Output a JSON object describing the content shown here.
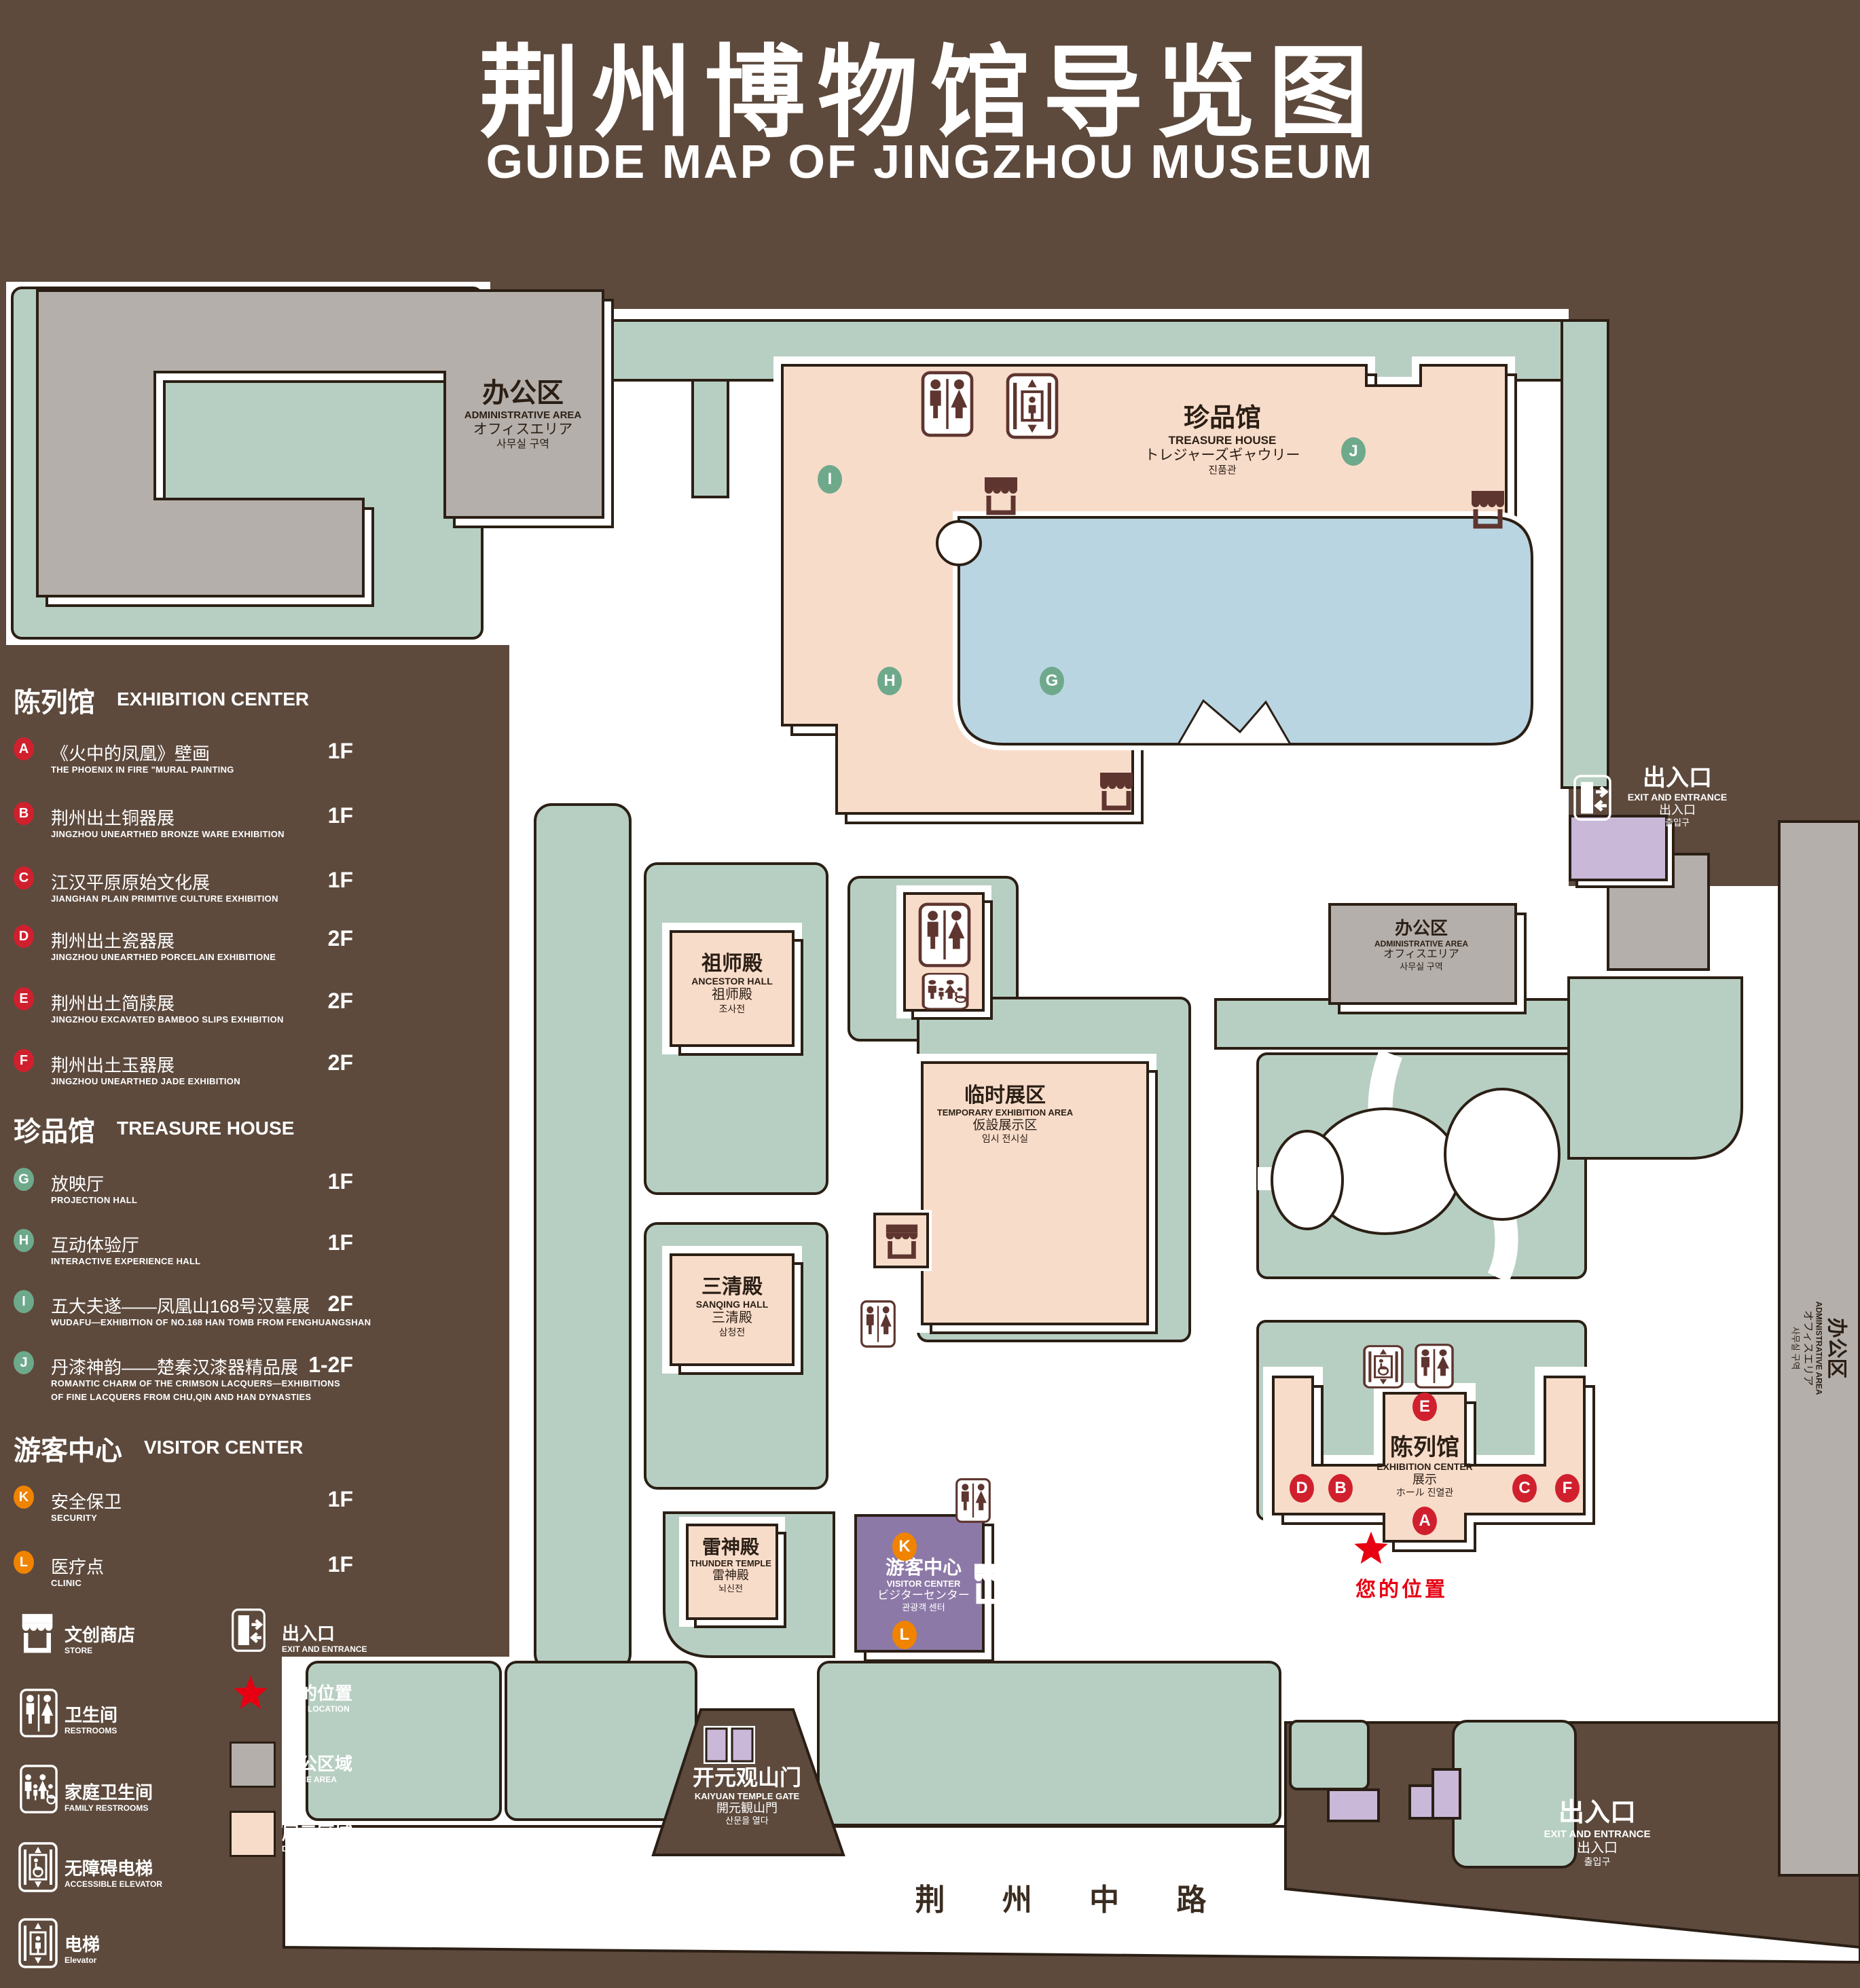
{
  "title": {
    "cn": "荆州博物馆导览图",
    "en": "GUIDE MAP OF JINGZHOU MUSEUM"
  },
  "theme": {
    "background": "#5d4a3d",
    "lawn": "#b7cfc2",
    "display_area": "#f8dcca",
    "office_area": "#b5afab",
    "lake": "#bad5e2",
    "visitor_center": "#8d79a7",
    "lavender": "#c9b8d8",
    "outline": "#2b1f15",
    "marker_red": "#d0202e",
    "marker_green": "#6ea98b",
    "marker_orange": "#f08300",
    "location_red": "#e60012",
    "icon_brown": "#5e352f"
  },
  "legend": {
    "sections": [
      {
        "cn": "陈列馆",
        "en": "EXHIBITION CENTER",
        "items": [
          {
            "letter": "A",
            "cn": "《火中的凤凰》壁画",
            "en": "THE PHOENIX IN FIRE \"MURAL PAINTING",
            "floor": "1F"
          },
          {
            "letter": "B",
            "cn": "荆州出土铜器展",
            "en": "JINGZHOU UNEARTHED BRONZE WARE EXHIBITION",
            "floor": "1F"
          },
          {
            "letter": "C",
            "cn": "江汉平原原始文化展",
            "en": "JIANGHAN PLAIN PRIMITIVE CULTURE EXHIBITION",
            "floor": "1F"
          },
          {
            "letter": "D",
            "cn": "荆州出土瓷器展",
            "en": "JINGZHOU UNEARTHED PORCELAIN EXHIBITIONE",
            "floor": "2F"
          },
          {
            "letter": "E",
            "cn": "荆州出土简牍展",
            "en": "JINGZHOU EXCAVATED BAMBOO SLIPS EXHIBITION",
            "floor": "2F"
          },
          {
            "letter": "F",
            "cn": "荆州出土玉器展",
            "en": "JINGZHOU UNEARTHED JADE EXHIBITION",
            "floor": "2F"
          }
        ]
      },
      {
        "cn": "珍品馆",
        "en": "TREASURE HOUSE",
        "items": [
          {
            "letter": "G",
            "cn": "放映厅",
            "en": "PROJECTION HALL",
            "floor": "1F"
          },
          {
            "letter": "H",
            "cn": "互动体验厅",
            "en": "INTERACTIVE EXPERIENCE HALL",
            "floor": "1F"
          },
          {
            "letter": "I",
            "cn": "五大夫遂——凤凰山168号汉墓展",
            "en": "WUDAFU—EXHIBITION OF NO.168 HAN TOMB FROM FENGHUANGSHAN",
            "floor": "2F"
          },
          {
            "letter": "J",
            "cn": "丹漆神韵——楚秦汉漆器精品展",
            "en": "ROMANTIC CHARM OF THE CRIMSON LACQUERS—EXHIBITIONS",
            "en2": "OF FINE LACQUERS FROM CHU,QIN AND HAN DYNASTIES",
            "floor": "1-2F"
          }
        ]
      },
      {
        "cn": "游客中心",
        "en": "VISITOR CENTER",
        "items": [
          {
            "letter": "K",
            "cn": "安全保卫",
            "en": "SECURITY",
            "floor": "1F"
          },
          {
            "letter": "L",
            "cn": "医疗点",
            "en": "CLINIC",
            "floor": "1F"
          }
        ]
      }
    ],
    "icons": [
      {
        "icon": "store-icon",
        "cn": "文创商店",
        "en": "STORE"
      },
      {
        "icon": "exit-icon",
        "cn": "出入口",
        "en": "EXIT AND ENTRANCE"
      },
      {
        "icon": "restroom-icon",
        "cn": "卫生间",
        "en": "RESTROOMS"
      },
      {
        "icon": "location-star-icon",
        "cn": "您的位置",
        "en": "YOUR LOCATION"
      },
      {
        "icon": "family-restroom-icon",
        "cn": "家庭卫生间",
        "en": "FAMILY RESTROOMS"
      },
      {
        "icon": "office-area-swatch",
        "cn": "办公区域",
        "en": "OFFICE AREA"
      },
      {
        "icon": "accessible-elevator-icon",
        "cn": "无障碍电梯",
        "en": "ACCESSIBLE ELEVATOR"
      },
      {
        "icon": "display-area-swatch",
        "cn": "展示区域",
        "en": "DISPLAY AREA"
      },
      {
        "icon": "elevator-icon",
        "cn": "电梯",
        "en": "Elevator"
      }
    ]
  },
  "map": {
    "buildings": {
      "admin_tl": {
        "cn": "办公区",
        "en": "ADMINISTRATIVE AREA",
        "jp": "オフィスエリア",
        "kr": "사무실 구역"
      },
      "treasure": {
        "cn": "珍品馆",
        "en": "TREASURE HOUSE",
        "jp": "トレジャーズギャウリー",
        "kr": "진품관"
      },
      "ancestor": {
        "cn": "祖师殿",
        "en": "ANCESTOR HALL",
        "cn2": "祖师殿",
        "kr": "조사전"
      },
      "temp": {
        "cn": "临时展区",
        "en": "TEMPORARY EXHIBITION AREA",
        "jp": "仮設展示区",
        "kr": "임시 전시실"
      },
      "sanqing": {
        "cn": "三清殿",
        "en": "SANQING HALL",
        "cn2": "三清殿",
        "kr": "삼청전"
      },
      "thunder": {
        "cn": "雷神殿",
        "en": "THUNDER TEMPLE",
        "cn2": "雷神殿",
        "kr": "뇌신전"
      },
      "visitor": {
        "cn": "游客中心",
        "en": "VISITOR CENTER",
        "jp": "ビジターセンター",
        "kr": "관광객 센터"
      },
      "exhibition": {
        "cn": "陈列馆",
        "en": "EXHIBITION CENTER",
        "cn2": "展示",
        "jkr": "ホール 진열관"
      },
      "admin_cr": {
        "cn": "办公区",
        "en": "ADMINISTRATIVE AREA",
        "jp": "オフィスエリア",
        "kr": "사무실 구역"
      },
      "admin_right": {
        "cn": "办公区",
        "en": "ADMINISTRATIVE AREA",
        "jp": "オフィスエリア",
        "kr": "사무실 구역"
      },
      "exit_right": {
        "cn": "出入口",
        "en": "EXIT AND ENTRANCE",
        "cn2": "出入口",
        "kr": "출입구"
      },
      "exit_bottom": {
        "cn": "出入口",
        "en": "EXIT AND ENTRANCE",
        "cn2": "出入口",
        "kr": "출입구"
      },
      "gate": {
        "cn": "开元观山门",
        "en": "KAIYUAN TEMPLE GATE",
        "jp": "開元観山門",
        "kr": "산문을 열다"
      }
    },
    "road": {
      "name": "荆 州 中 路"
    },
    "your_location": {
      "label": "您的位置"
    },
    "markers": [
      {
        "letter": "I"
      },
      {
        "letter": "J"
      },
      {
        "letter": "H"
      },
      {
        "letter": "G"
      },
      {
        "letter": "E"
      },
      {
        "letter": "A"
      },
      {
        "letter": "D"
      },
      {
        "letter": "B"
      },
      {
        "letter": "C"
      },
      {
        "letter": "F"
      },
      {
        "letter": "K"
      },
      {
        "letter": "L"
      }
    ]
  }
}
